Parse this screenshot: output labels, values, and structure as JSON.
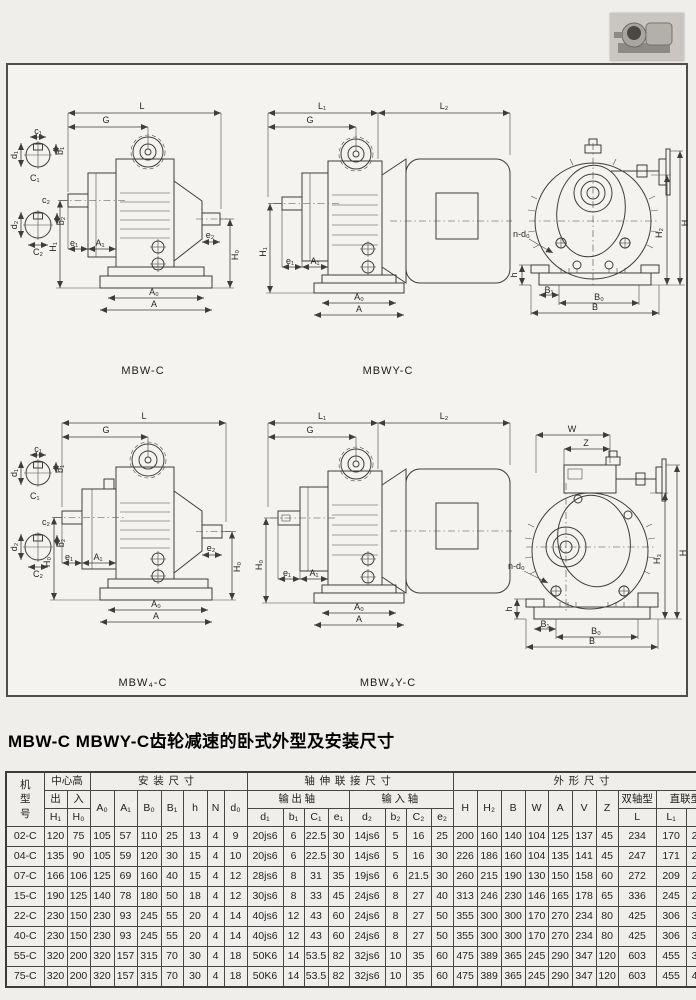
{
  "title": "MBW-C MBWY-C齿轮减速的卧式外型及安装尺寸",
  "photo": {
    "name": "gear-motor-photo"
  },
  "drawings": {
    "captions": {
      "a": "MBW-C",
      "b": "MBWY-C",
      "d": "MBW₄-C",
      "e": "MBW₄Y-C"
    },
    "dims": {
      "L": "L",
      "L1": "L₁",
      "L2": "L₂",
      "G": "G",
      "H1": "H₁",
      "H0": "H₀",
      "H": "H",
      "H2": "H₂",
      "H3": "H₃",
      "e1": "e₁",
      "e2": "e₂",
      "A1": "A₁",
      "A0": "A₀",
      "A": "A",
      "B": "B",
      "B0": "B₀",
      "B1": "B₁",
      "h": "h",
      "ndo": "n-d₀",
      "W": "W",
      "Z": "Z",
      "c1": "c₁",
      "b1": "b₁",
      "d1": "d₁",
      "C1": "C₁",
      "c2": "c₂",
      "b2": "b₂",
      "d2": "d₂",
      "C2": "C₂"
    }
  },
  "table": {
    "group_headers": {
      "model": "机型号",
      "center_height": "中心高",
      "out": "出",
      "in": "入",
      "mounting": "安装尺寸",
      "shaft_conn": "轴伸联接尺寸",
      "out_shaft": "输出轴",
      "in_shaft": "输入轴",
      "outline": "外形尺寸",
      "double_shaft": "双轴型",
      "direct_type": "直联型"
    },
    "col_headers": {
      "H1": "H₁",
      "H0": "H₀",
      "A0": "A₀",
      "A1": "A₁",
      "B0": "B₀",
      "B1": "B₁",
      "h": "h",
      "N": "N",
      "d0": "d₀",
      "d1": "d₁",
      "b1": "b₁",
      "C1": "C₁",
      "e1": "e₁",
      "d2": "d₂",
      "b2": "b₂",
      "C2": "C₂",
      "e2": "e₂",
      "H": "H",
      "H2": "H₂",
      "B": "B",
      "W": "W",
      "A": "A",
      "V": "V",
      "Z": "Z",
      "L": "L",
      "L1": "L₁",
      "L2": "L₂"
    },
    "rows": [
      {
        "model": "02-C",
        "values": [
          "120",
          "75",
          "105",
          "57",
          "110",
          "25",
          "13",
          "4",
          "9",
          "20js6",
          "6",
          "22.5",
          "30",
          "14js6",
          "5",
          "16",
          "25",
          "200",
          "160",
          "140",
          "104",
          "125",
          "137",
          "45",
          "234",
          "170",
          "200"
        ]
      },
      {
        "model": "04-C",
        "values": [
          "135",
          "90",
          "105",
          "59",
          "120",
          "30",
          "15",
          "4",
          "10",
          "20js6",
          "6",
          "22.5",
          "30",
          "14js6",
          "5",
          "16",
          "30",
          "226",
          "186",
          "160",
          "104",
          "135",
          "141",
          "45",
          "247",
          "171",
          "235"
        ]
      },
      {
        "model": "07-C",
        "values": [
          "166",
          "106",
          "125",
          "69",
          "160",
          "40",
          "15",
          "4",
          "12",
          "28js6",
          "8",
          "31",
          "35",
          "19js6",
          "6",
          "21.5",
          "30",
          "260",
          "215",
          "190",
          "130",
          "150",
          "158",
          "60",
          "272",
          "209",
          "245"
        ]
      },
      {
        "model": "15-C",
        "values": [
          "190",
          "125",
          "140",
          "78",
          "180",
          "50",
          "18",
          "4",
          "12",
          "30js6",
          "8",
          "33",
          "45",
          "24js6",
          "8",
          "27",
          "40",
          "313",
          "246",
          "230",
          "146",
          "165",
          "178",
          "65",
          "336",
          "245",
          "285"
        ]
      },
      {
        "model": "22-C",
        "values": [
          "230",
          "150",
          "230",
          "93",
          "245",
          "55",
          "20",
          "4",
          "14",
          "40js6",
          "12",
          "43",
          "60",
          "24js6",
          "8",
          "27",
          "50",
          "355",
          "300",
          "300",
          "170",
          "270",
          "234",
          "80",
          "425",
          "306",
          "320"
        ]
      },
      {
        "model": "40-C",
        "values": [
          "230",
          "150",
          "230",
          "93",
          "245",
          "55",
          "20",
          "4",
          "14",
          "40js6",
          "12",
          "43",
          "60",
          "24js6",
          "8",
          "27",
          "50",
          "355",
          "300",
          "300",
          "170",
          "270",
          "234",
          "80",
          "425",
          "306",
          "340"
        ]
      },
      {
        "model": "55-C",
        "values": [
          "320",
          "200",
          "320",
          "157",
          "315",
          "70",
          "30",
          "4",
          "18",
          "50K6",
          "14",
          "53.5",
          "82",
          "32js6",
          "10",
          "35",
          "60",
          "475",
          "389",
          "365",
          "245",
          "290",
          "347",
          "120",
          "603",
          "455",
          "395"
        ]
      },
      {
        "model": "75-C",
        "values": [
          "320",
          "200",
          "320",
          "157",
          "315",
          "70",
          "30",
          "4",
          "18",
          "50K6",
          "14",
          "53.5",
          "82",
          "32js6",
          "10",
          "35",
          "60",
          "475",
          "389",
          "365",
          "245",
          "290",
          "347",
          "120",
          "603",
          "455",
          "435"
        ]
      }
    ]
  }
}
